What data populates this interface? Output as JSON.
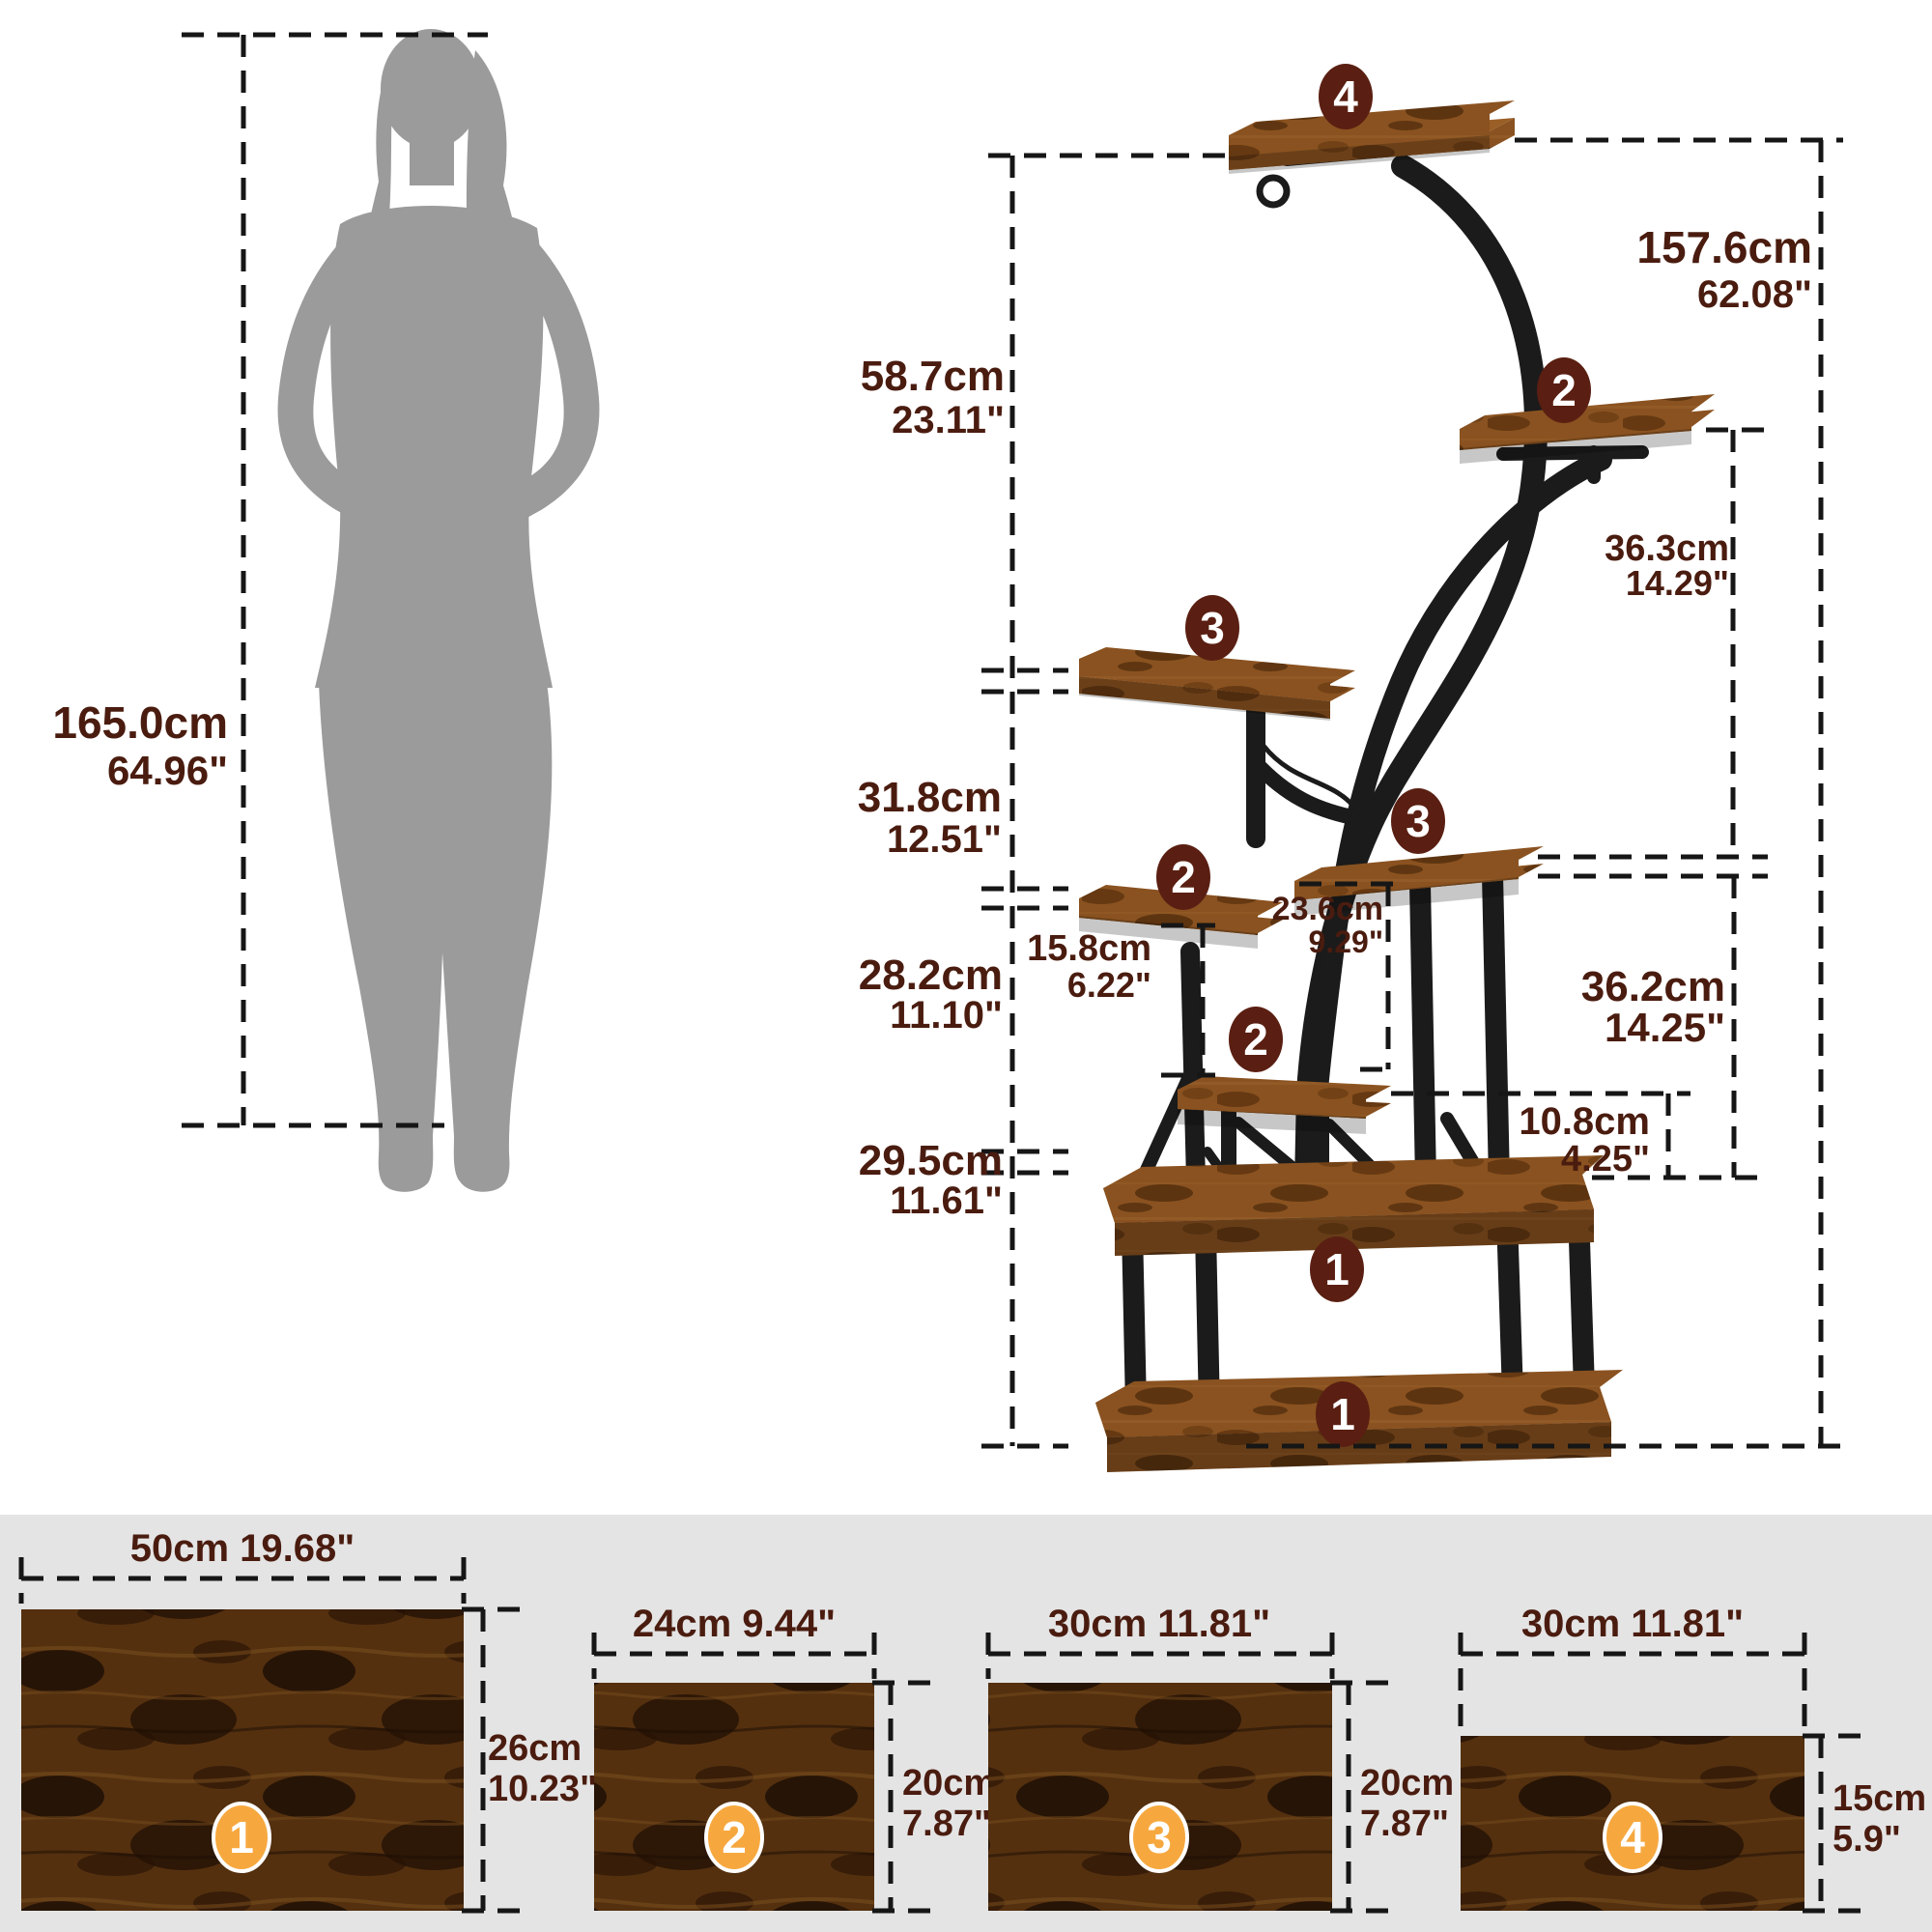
{
  "person": {
    "cm": "165.0cm",
    "inch": "64.96\""
  },
  "overall": {
    "cm": "157.6cm",
    "inch": "62.08\""
  },
  "stand_dims": {
    "d587": {
      "cm": "58.7cm",
      "inch": "23.11\""
    },
    "d318": {
      "cm": "31.8cm",
      "inch": "12.51\""
    },
    "d282": {
      "cm": "28.2cm",
      "inch": "11.10\""
    },
    "d295": {
      "cm": "29.5cm",
      "inch": "11.61\""
    },
    "d158": {
      "cm": "15.8cm",
      "inch": "6.22\""
    },
    "d236": {
      "cm": "23.6cm",
      "inch": "9.29\""
    },
    "d363": {
      "cm": "36.3cm",
      "inch": "14.29\""
    },
    "d362": {
      "cm": "36.2cm",
      "inch": "14.25\""
    },
    "d108": {
      "cm": "10.8cm",
      "inch": "4.25\""
    }
  },
  "stand_badges": {
    "top": "4",
    "upper_right": "2",
    "mid_left": "3",
    "mid_right": "3",
    "lower_left": "2",
    "lower_mid": "2",
    "base_upper": "1",
    "base_lower": "1"
  },
  "panels": [
    {
      "num": "1",
      "width": "50cm 19.68\"",
      "height_cm": "26cm",
      "height_inch": "10.23\""
    },
    {
      "num": "2",
      "width": "24cm 9.44\"",
      "height_cm": "20cm",
      "height_inch": "7.87\""
    },
    {
      "num": "3",
      "width": "30cm 11.81\"",
      "height_cm": "20cm",
      "height_inch": "7.87\""
    },
    {
      "num": "4",
      "width": "30cm 11.81\"",
      "height_cm": "15cm",
      "height_inch": "5.9\""
    }
  ],
  "colors": {
    "label_brown": "#4a1c0f",
    "badge_dark": "#5a1f12",
    "badge_orange": "#f6a83f",
    "wood": "#8a5220",
    "silhouette": "#9b9b9b",
    "band_gray": "#e4e4e4"
  }
}
